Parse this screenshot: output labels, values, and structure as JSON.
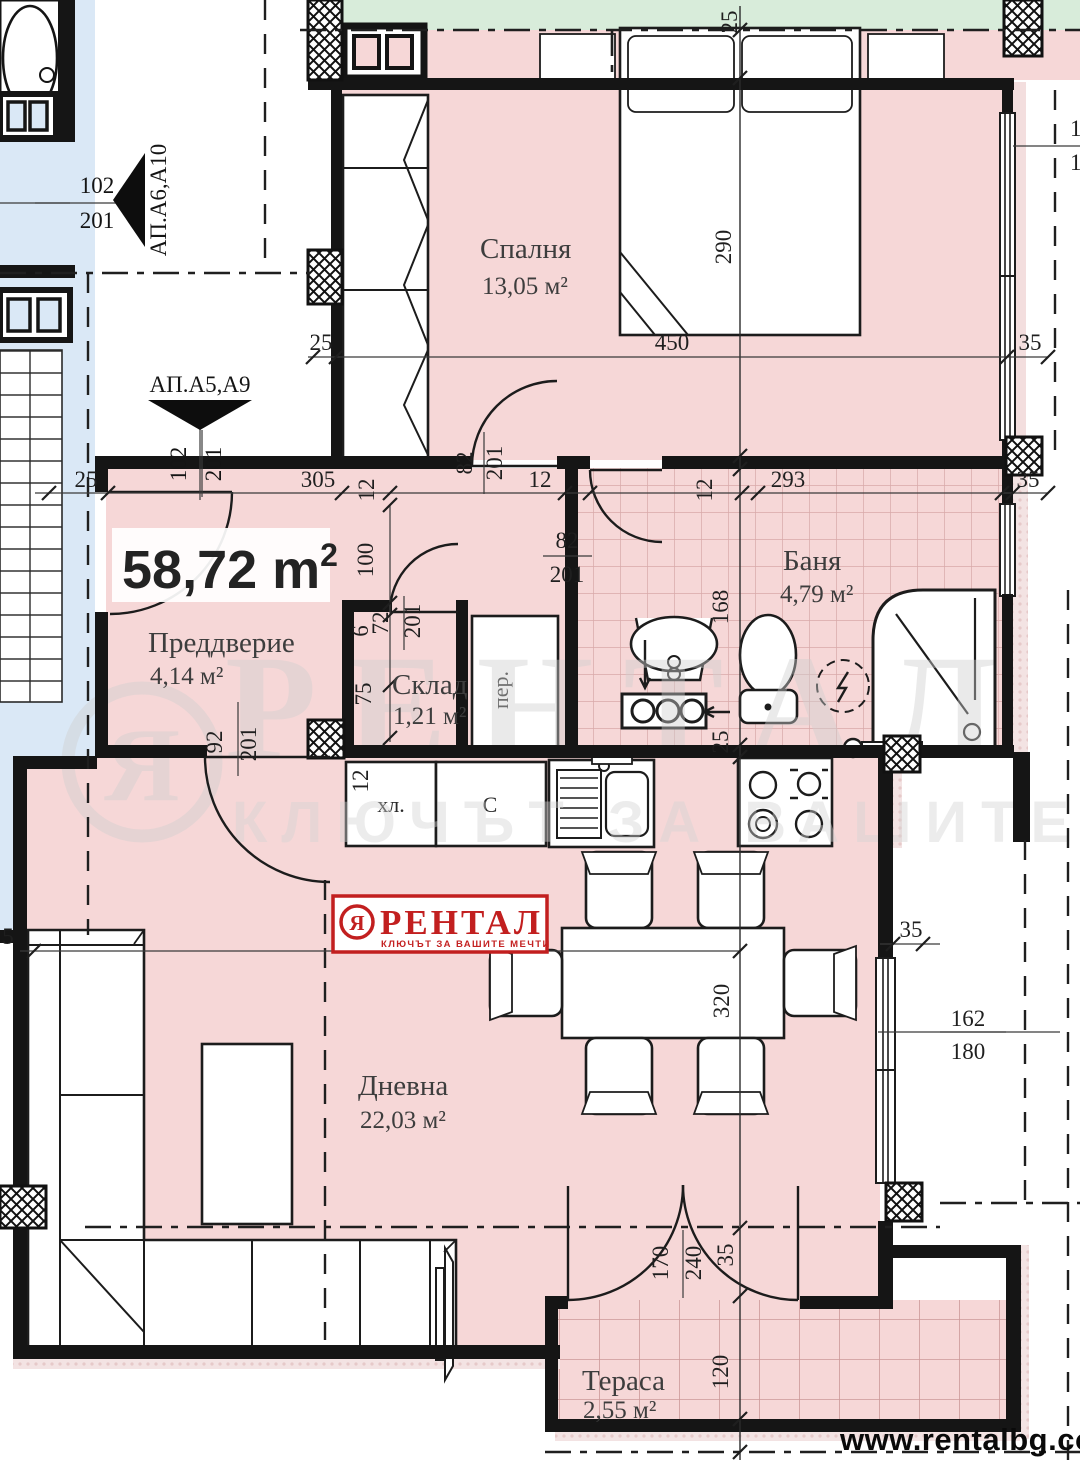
{
  "plan": {
    "type": "apartment-floor-plan",
    "total_area": {
      "value": "58,72 m",
      "sup": "2"
    },
    "footer": {
      "website": "www.rentalbg.com"
    },
    "logo": {
      "brand": "РЕНТАЛ",
      "tagline": "КЛЮЧЪТ ЗА ВАШИТЕ МЕЧТИ",
      "symbol": "Я"
    },
    "watermark": {
      "brand": "РЕНТАЛ",
      "tagline": "КЛЮЧЪТ ЗА ВАШИТЕ МЕЧТИ"
    }
  },
  "rooms": {
    "bedroom": {
      "name": "Спалня",
      "area": "13,05 м²"
    },
    "bathroom": {
      "name": "Баня",
      "area": "4,79 м²"
    },
    "hall": {
      "name": "Преддверие",
      "area": "4,14 м²"
    },
    "storage": {
      "name": "Склад",
      "area": "1,21 м²"
    },
    "living": {
      "name": "Дневна",
      "area": "22,03 м²"
    },
    "terrace": {
      "name": "Тераса",
      "area": "2,55 м²"
    }
  },
  "fixtures": {
    "fridge": "хл.",
    "cabinet": "С",
    "washer": "пер."
  },
  "markers": {
    "a6": {
      "name": "АП.А6,А10",
      "num": "102",
      "den": "201"
    },
    "a5": {
      "name": "АП.А5,А9",
      "num": "102",
      "den": "201"
    }
  },
  "dims": {
    "v25_top": "25",
    "h450": "450",
    "h35_tr": "35",
    "v290": "290",
    "h15": "15",
    "h18": "18",
    "h25_left": "25",
    "h25_bl": "25",
    "h305": "305",
    "v12_a": "12",
    "v82_door": "82",
    "v201_door": "201",
    "h12_b": "12",
    "h82_bath": "82",
    "h201_bath": "201",
    "v12_c": "12",
    "h293": "293",
    "h35_r": "35",
    "v100": "100",
    "v6": "6",
    "v72": "72",
    "v201_skl": "201",
    "v75": "75",
    "v92": "92",
    "v201_ent": "201",
    "v168": "168",
    "v25_bath": "25",
    "v12_k": "12",
    "h590": "590",
    "v320": "320",
    "h35_k": "35",
    "h162": "162",
    "h180": "180",
    "v170": "170",
    "v240": "240",
    "v35_t": "35",
    "v120": "120",
    "h5": "5"
  },
  "colors": {
    "room_fill": "#f6d7d7",
    "tile_line": "#d8a9a9",
    "green_strip": "#d8ecda",
    "blue_zone": "#dae8f6",
    "logo_red": "#c21f1f",
    "watermark_gray": "#d2d2d2"
  }
}
